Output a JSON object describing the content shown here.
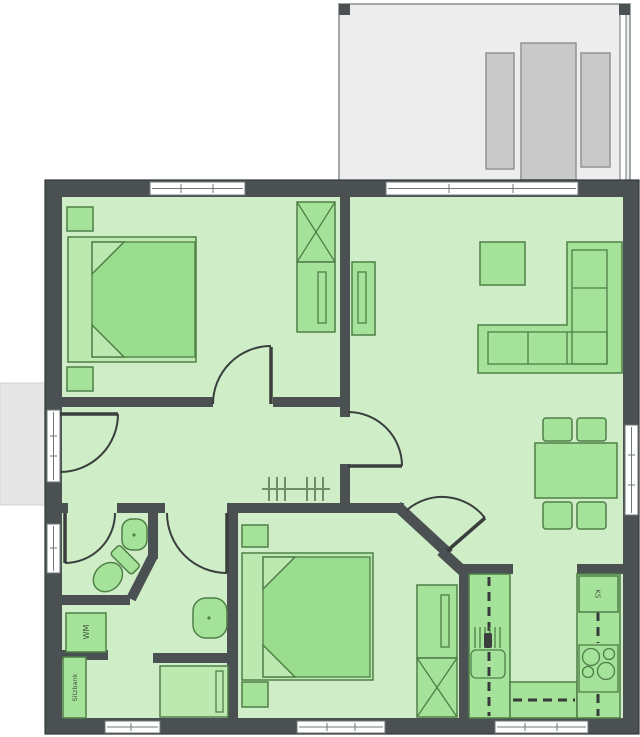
{
  "labels": {
    "washing_machine": "WM",
    "bench": "Sitzbank",
    "fridge": "KS"
  },
  "colors": {
    "wall": "#4b5052",
    "floor": "#cfeec7",
    "furn": "#a6e39a",
    "furn_border": "#4f7f47",
    "furn_light": "#bce9b0",
    "furn_dark": "#9bdd8f",
    "door": "#3a3f3e",
    "window_frame": "#70777a",
    "terrace": "#ededed",
    "terrace_border": "#a2a7a7",
    "lounger": "#c9c9c9",
    "lounger_border": "#8f9494",
    "walkway": "#e6e6e6",
    "coatrack": "#718c6a",
    "dash": "#363b3a"
  }
}
